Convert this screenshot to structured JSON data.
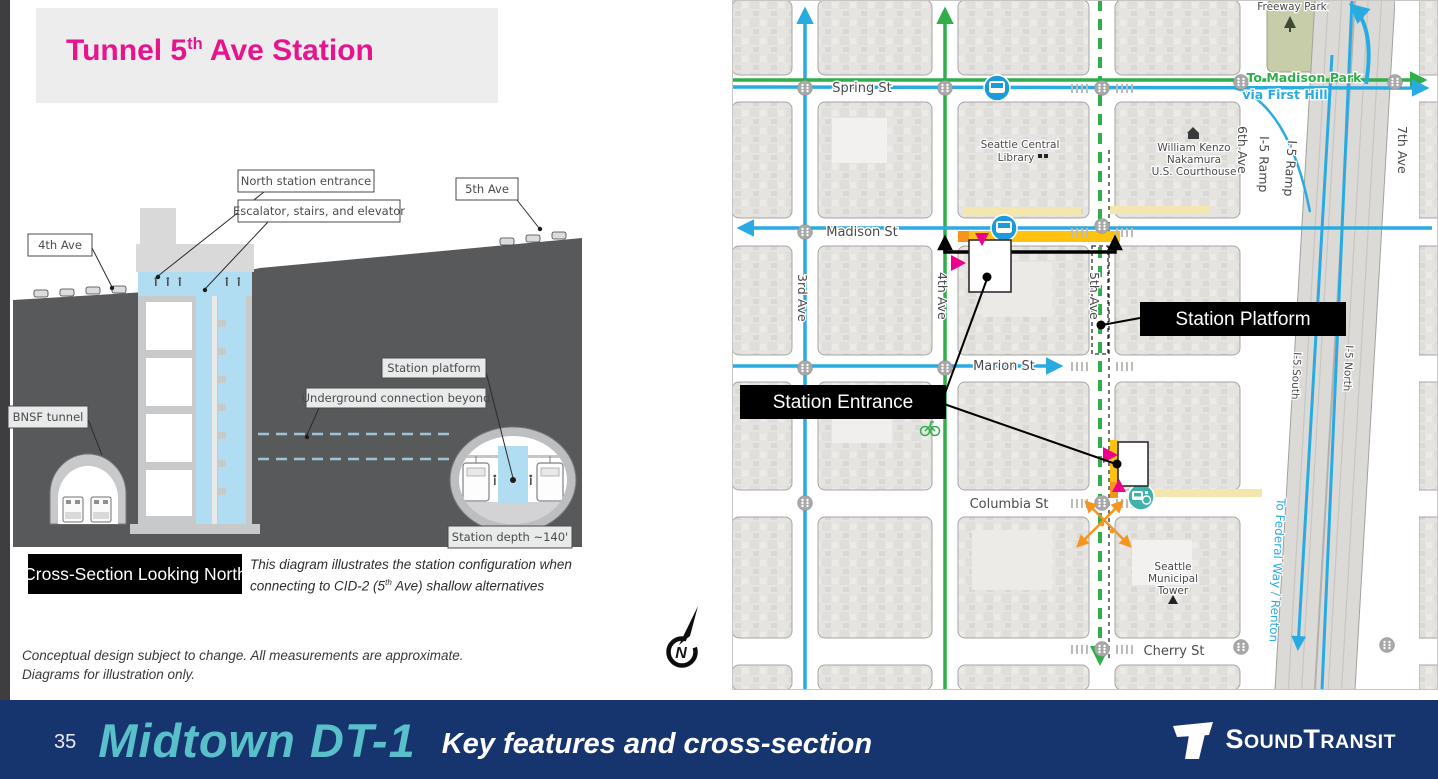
{
  "slide": {
    "title": {
      "pre": "Tunnel 5",
      "sup": "th",
      "post": " Ave Station"
    },
    "disclaimer_line1": "Conceptual design subject to change. All measurements are approximate.",
    "disclaimer_line2": "Diagrams for illustration only."
  },
  "cross_section": {
    "labels": {
      "ave4": "4th Ave",
      "north_entrance": "North station entrance",
      "escalator": "Escalator, stairs, and elevator",
      "ave5": "5th Ave",
      "bnsf": "BNSF tunnel",
      "underground": "Underground connection beyond",
      "platform": "Station platform",
      "depth": "Station depth ~140'"
    },
    "caption": "Cross-Section Looking North",
    "note_line1": "This diagram illustrates the station configuration when",
    "note_line2_pre": "connecting to CID-2 (5",
    "note_line2_sup": "th",
    "note_line2_post": " Ave) shallow alternatives"
  },
  "map": {
    "streets": {
      "spring": "Spring St",
      "madison": "Madison St",
      "marion": "Marion St",
      "columbia": "Columbia St",
      "cherry": "Cherry St",
      "ave3": "3rd Ave",
      "ave4": "4th Ave",
      "ave5": "5th Ave",
      "ave6": "6th Ave",
      "ave7": "7th Ave",
      "ramp_a": "I-5 Ramp",
      "ramp_b": "I-5 Ramp",
      "i5_south": "I-5 South",
      "i5_north": "I-5 North"
    },
    "places": {
      "library_line1": "Seattle Central",
      "library_line2": "Library",
      "courthouse_line1": "William Kenzo",
      "courthouse_line2": "Nakamura",
      "courthouse_line3": "U.S. Courthouse",
      "tower_line1": "Seattle",
      "tower_line2": "Municipal",
      "tower_line3": "Tower",
      "park": "Freeway Park"
    },
    "directions": {
      "madison_park": "To Madison Park",
      "first_hill": "via First Hill",
      "federal_way": "To Federal Way / Renton"
    },
    "callouts": {
      "platform": "Station Platform",
      "entrance": "Station Entrance"
    }
  },
  "compass": {
    "label": "N"
  },
  "footer": {
    "page_number": "35",
    "route_name": "Midtown DT-1",
    "subtitle": "Key features and cross-section",
    "brand": {
      "s": "S",
      "ound": "OUND",
      "t": "T",
      "ransit": "RANSIT"
    }
  },
  "colors": {
    "accent_magenta": "#e6158e",
    "map_blue": "#29abe2",
    "map_green": "#2fae4a",
    "highlight_yellow": "#ffc20e",
    "highlight_orange": "#f7941d",
    "ground_gray": "#58595b",
    "shaft_blue": "#b0ddf1",
    "footer_navy": "#16356e",
    "footer_teal": "#58bfcb"
  }
}
